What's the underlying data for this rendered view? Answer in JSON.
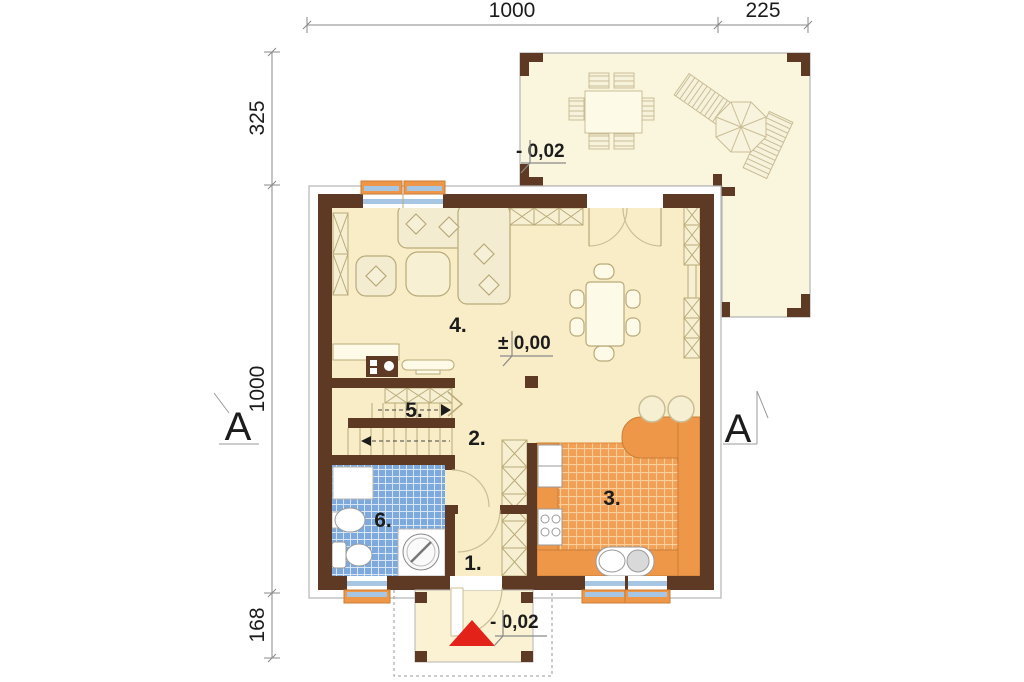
{
  "plan": {
    "dimensions": {
      "top": [
        {
          "label": "1000"
        },
        {
          "label": "225"
        }
      ],
      "left": [
        {
          "label": "325"
        },
        {
          "label": "1000"
        },
        {
          "label": "168"
        }
      ]
    },
    "rooms": {
      "r1": {
        "label": "1."
      },
      "r2": {
        "label": "2."
      },
      "r3": {
        "label": "3."
      },
      "r4": {
        "label": "4."
      },
      "r5": {
        "label": "5."
      },
      "r6": {
        "label": "6."
      }
    },
    "levels": {
      "terrace": "- 0,02",
      "main": "± 0,00",
      "entrance": "- 0,02"
    },
    "sections": {
      "left": "A",
      "right": "A"
    },
    "colors": {
      "wall": "#5e3a24",
      "floor_cream": "#f9edc8",
      "terrace_cream": "#faf6dd",
      "kitchen_orange": "#ef9749",
      "kitchen_tile": "#f1a055",
      "bathroom_tile": "#7da9dc",
      "window_glass_blue": "#a6c6e4",
      "entrance_marker_red": "#e32219"
    }
  }
}
